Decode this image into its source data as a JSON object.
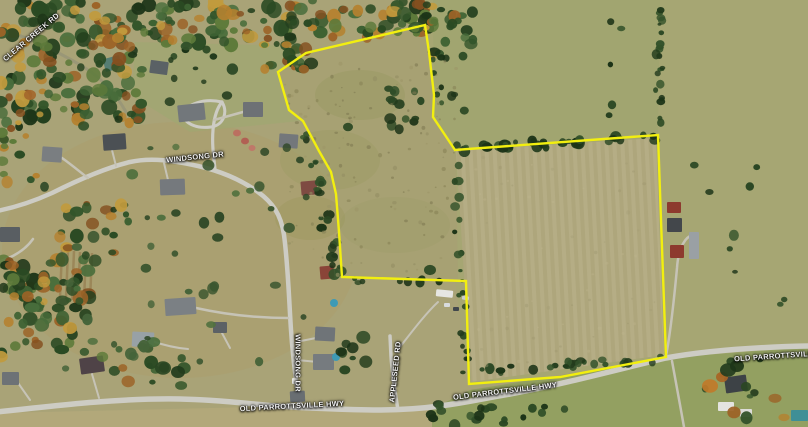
{
  "map": {
    "type": "aerial-satellite-parcel-map",
    "boundary_color": "#f2ef0f",
    "road_labels": [
      {
        "id": "clear-creek-rd",
        "text": "CLEAR CREEK RD"
      },
      {
        "id": "windsong-dr",
        "text": "WINDSONG DR"
      },
      {
        "id": "windsong-dr-vertical",
        "text": "WINDSONG DR"
      },
      {
        "id": "appleseed-rd",
        "text": "APPLESEED RD"
      },
      {
        "id": "old-parrottsville-hwy-center",
        "text": "OLD PARROTTSVILLE HWY"
      },
      {
        "id": "old-parrottsville-hwy-east",
        "text": "OLD PARROTTSVILLE HWY"
      },
      {
        "id": "old-parrottsville-right-edge",
        "text": "OLD PARROTTSVILLE"
      }
    ],
    "colors": {
      "field_tan": "#b2aa82",
      "pasture_olive": "#a6a673",
      "forest_green": "#2a4a23",
      "autumn_orange": "#b5812f",
      "road_gray": "#cdccc4",
      "lawn_green": "#93a061",
      "pool_blue": "#3e9ab5"
    }
  }
}
